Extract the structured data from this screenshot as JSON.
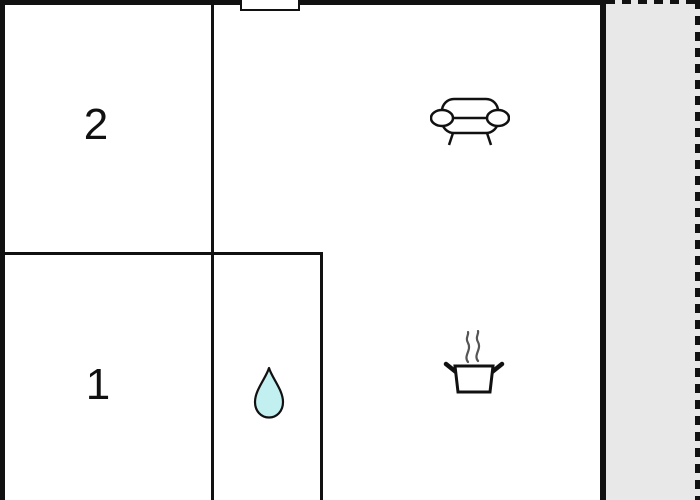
{
  "floorplan": {
    "title": "apartment-floor-plan",
    "rooms": [
      {
        "name": "room-2",
        "label": "2"
      },
      {
        "name": "room-1",
        "label": "1"
      }
    ],
    "icons": [
      {
        "name": "sofa-icon",
        "meaning": "sofa / living area"
      },
      {
        "name": "steam-pot-icon",
        "meaning": "cooking pot with steam / kitchen"
      },
      {
        "name": "water-drop-icon",
        "meaning": "water drop / bathroom"
      },
      {
        "name": "window-marker",
        "meaning": "window / opening in top wall"
      }
    ],
    "areas": [
      {
        "name": "terrace-area",
        "meaning": "outdoor area with dashed boundary"
      }
    ],
    "colors": {
      "wall": "#111111",
      "background": "#ffffff",
      "terrace_fill": "#e8e8e8",
      "water_drop_fill": "#c2f0f0",
      "steam": "#555555"
    }
  }
}
